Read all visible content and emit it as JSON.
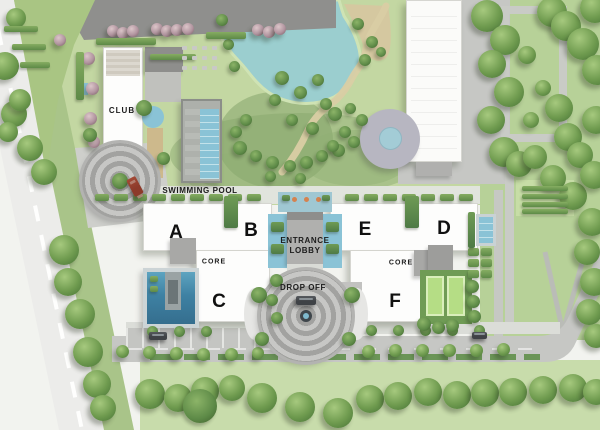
{
  "labels": {
    "club": "CLUB",
    "swimming_pool": "SWIMMING POOL",
    "entrance_lobby_line1": "ENTRANCE",
    "entrance_lobby_line2": "LOBBY",
    "drop_off": "DROP OFF",
    "core_west": "CORE",
    "core_east": "CORE"
  },
  "buildings": [
    {
      "id": "tower-a",
      "label": "A"
    },
    {
      "id": "tower-b",
      "label": "B"
    },
    {
      "id": "tower-c",
      "label": "C"
    },
    {
      "id": "tower-d",
      "label": "D"
    },
    {
      "id": "tower-e",
      "label": "E"
    },
    {
      "id": "tower-f",
      "label": "F"
    }
  ],
  "colors": {
    "base": "#f2f3ef",
    "park_green": "#c3d7a2",
    "park_dark": "#8fae74",
    "lawn_right": "#b7d198",
    "lawn_bottom": "#c8dcab",
    "corner_green": "#a9c583",
    "lake": "#9bcecf",
    "sand": "#d5c8a0",
    "road_light": "#ececea",
    "road_gray": "#c6c7c4",
    "pavers_dark": "#8f8f8d",
    "fountain_plaza": "#b7b6c1",
    "pond_blue": "#a3ccd6",
    "building_white": "#fdfdfc",
    "building_edge": "#d6d6d1",
    "structure_gray": "#a8a8a6",
    "structure_dark": "#8e8e8c",
    "pool_blue": "#8ac3d6",
    "pool_deep": "#3e81a3",
    "deck_tan": "#cdb98c",
    "walkway": "#e1e4dd",
    "court_green": "#b5dd85",
    "court_base": "#6f9b55",
    "hedge_green": "#5d8a47",
    "tree_light": "#a6c97e",
    "tree_green": "#6f9b4f",
    "tree_dark": "#4e7a3a",
    "flower_tree": "#b295a0",
    "car_red": "#8c3a2a",
    "car_dark": "#3f4246",
    "label_text": "#1c1c1c",
    "accent_orange": "#d4824f"
  }
}
